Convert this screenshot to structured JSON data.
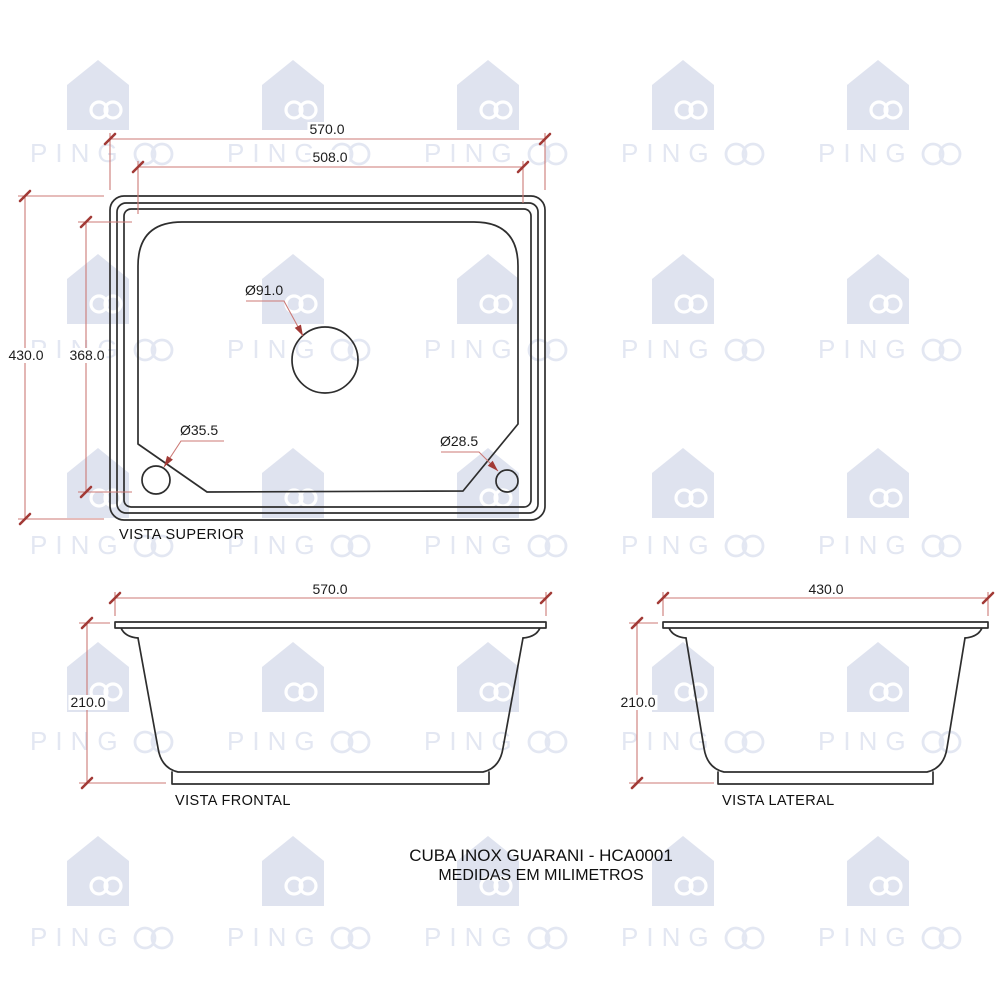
{
  "watermark": {
    "brand": "PINGOO",
    "text_prefix": "PING",
    "house_color": "#dfe3ef",
    "text_color": "#e3e7f2"
  },
  "drawing": {
    "line_color": "#2e2e2e",
    "dim_line_color": "#cc7a76",
    "dim_strong_color": "#a23a36"
  },
  "views": {
    "superior": {
      "label": "VISTA SUPERIOR",
      "dim_width_outer": "570.0",
      "dim_width_inner": "508.0",
      "dim_height_outer": "430.0",
      "dim_height_inner": "368.0",
      "hole_center": "Ø91.0",
      "hole_bottom_left": "Ø35.5",
      "hole_bottom_right": "Ø28.5"
    },
    "frontal": {
      "label": "VISTA FRONTAL",
      "dim_width": "570.0",
      "dim_height": "210.0"
    },
    "lateral": {
      "label": "VISTA LATERAL",
      "dim_width": "430.0",
      "dim_height": "210.0"
    }
  },
  "title": {
    "line1": "CUBA INOX GUARANI - HCA0001",
    "line2": "MEDIDAS EM MILIMETROS"
  }
}
